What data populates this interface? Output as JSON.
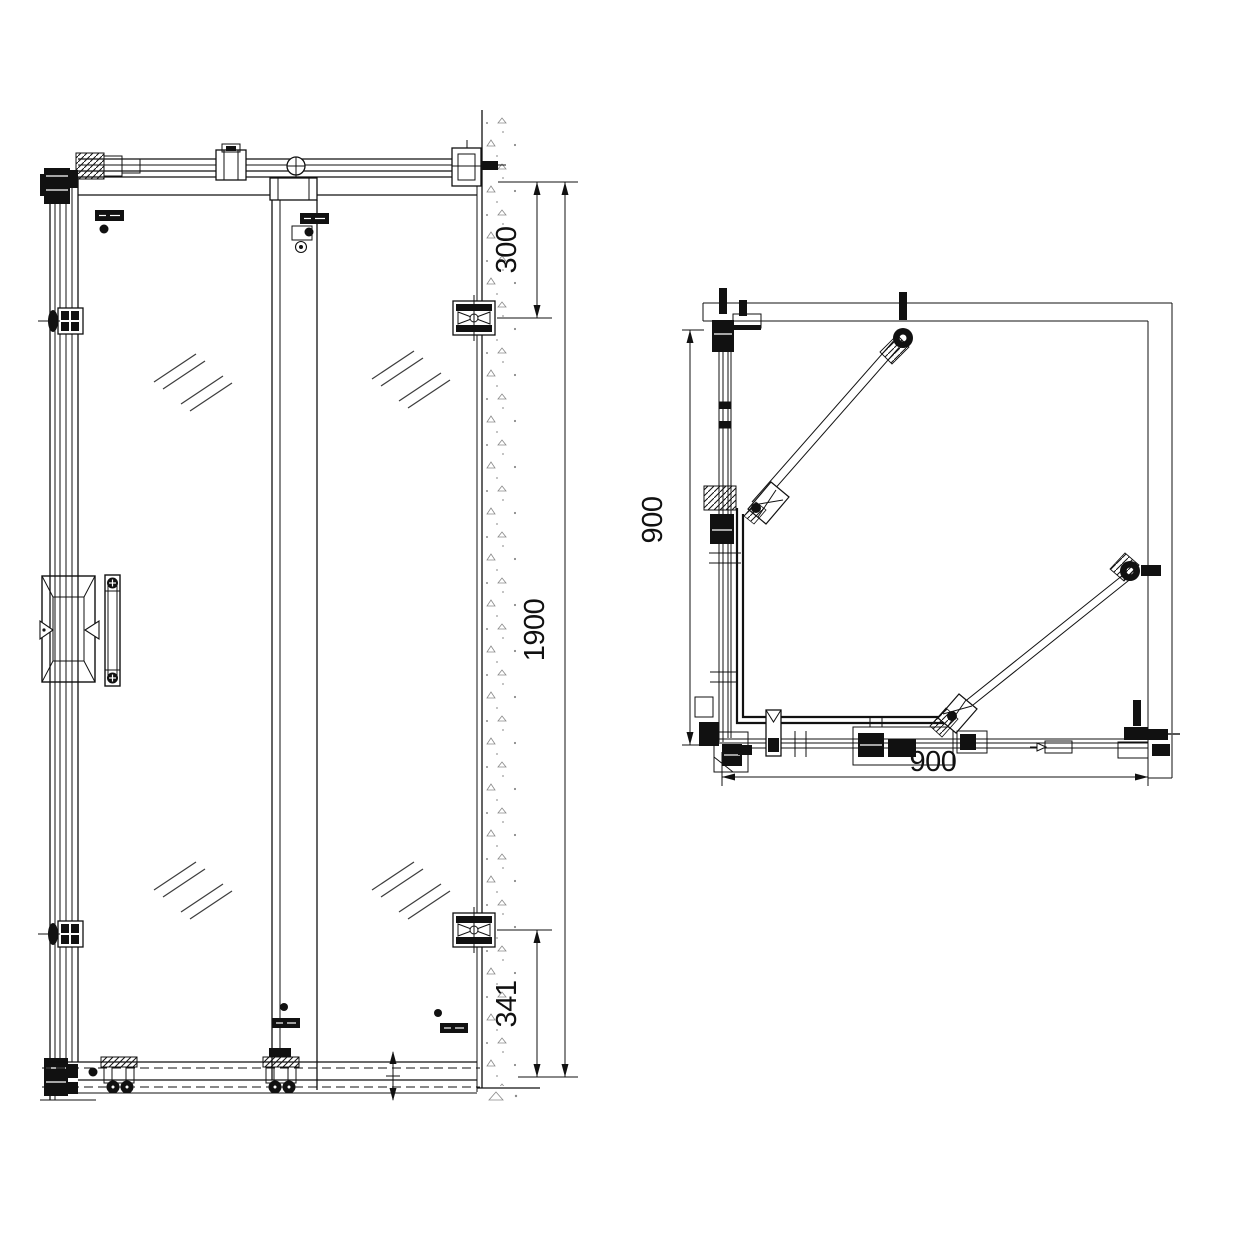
{
  "drawing_type": "shower enclosure CAD drawing",
  "colors": {
    "line": "#111111",
    "background": "#ffffff",
    "glass_mark": "#3d3d3d",
    "concrete_stipple": "#8a8a8a"
  },
  "views": {
    "front_elevation": {
      "dims": {
        "wall_top_offset": "300",
        "total_height": "1900",
        "wall_bottom_offset": "341"
      }
    },
    "plan": {
      "dims": {
        "side_depth": "900",
        "front_width": "900"
      }
    }
  }
}
